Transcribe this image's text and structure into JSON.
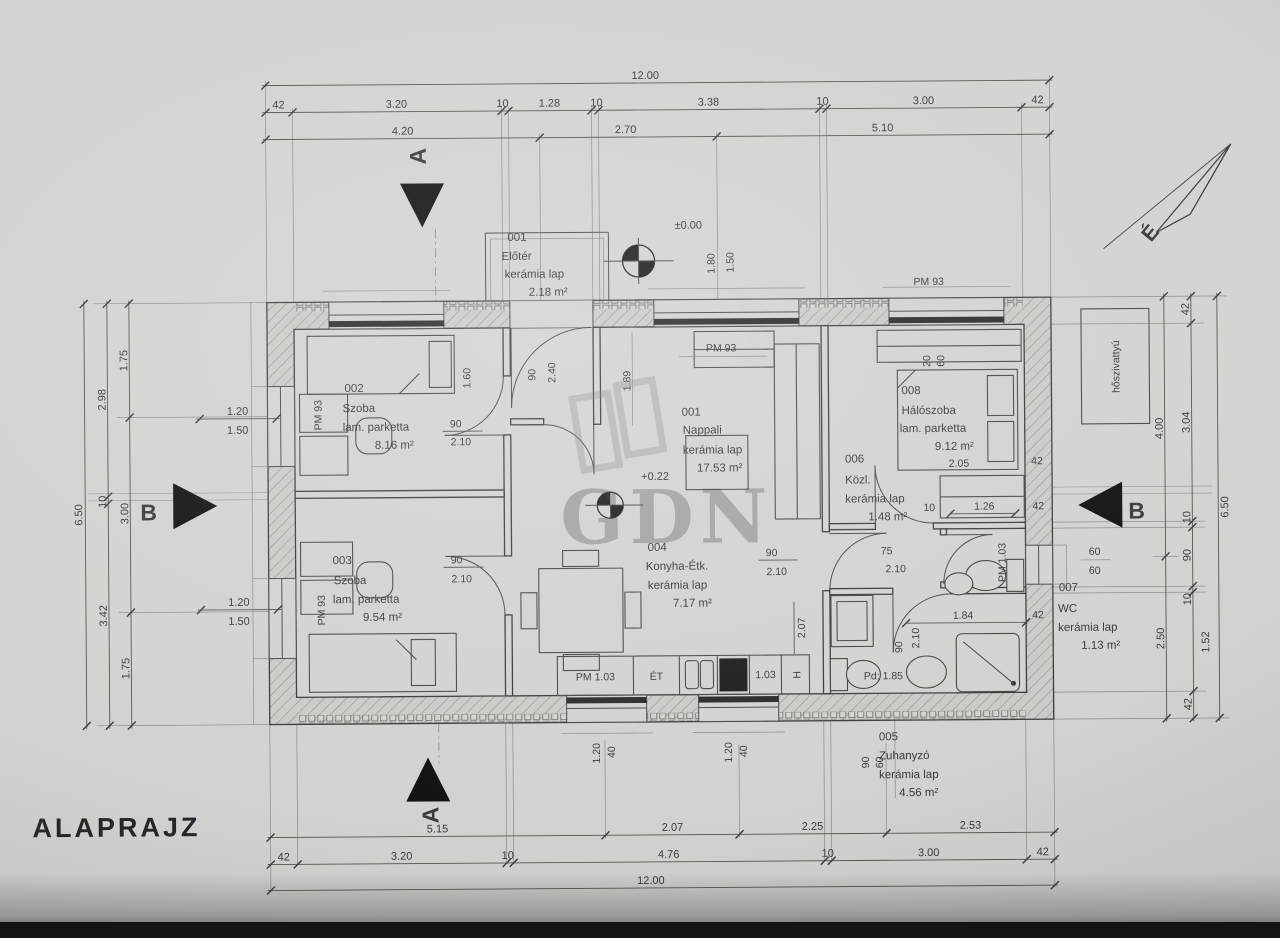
{
  "title": "ALAPRAJZ",
  "watermark": "GDN",
  "north_label": "É",
  "levels": {
    "zero": "±0.00",
    "floor": "+0.22"
  },
  "heat_pump_label": "hőszivattyú",
  "sections": {
    "a": "A",
    "b": "B"
  },
  "rooms": {
    "eloter": {
      "num": "001",
      "name": "Előtér",
      "floor": "kerámia lap",
      "area": "2.18 m²"
    },
    "szoba2": {
      "num": "002",
      "name": "Szoba",
      "floor": "lam. parketta",
      "area": "8.16 m²"
    },
    "szoba3": {
      "num": "003",
      "name": "Szoba",
      "floor": "lam. parketta",
      "area": "9.54 m²"
    },
    "nappali": {
      "num": "001",
      "name": "Nappali",
      "floor": "kerámia lap",
      "area": "17.53 m²"
    },
    "konyha": {
      "num": "004",
      "name": "Konyha-Étk.",
      "floor": "kerámia lap",
      "area": "7.17 m²"
    },
    "zuhanyzo": {
      "num": "005",
      "name": "Zuhanyzó",
      "floor": "kerámia lap",
      "area": "4.56 m²"
    },
    "kozl": {
      "num": "006",
      "name": "Közl.",
      "floor": "kerámia lap",
      "area": "1.48 m²"
    },
    "wc": {
      "num": "007",
      "name": "WC",
      "floor": "kerámia lap",
      "area": "1.13 m²"
    },
    "halo": {
      "num": "008",
      "name": "Hálószoba",
      "floor": "lam. parketta",
      "area": "9.12 m²"
    }
  },
  "pm_labels": {
    "top": "PM 93",
    "living": "PM 93",
    "szoba2": "PM 93",
    "szoba3": "PM 93",
    "bath": "PM 1.03"
  },
  "counter": {
    "pm": "PM 1.03",
    "et": "ÉT",
    "pm2": "1.03",
    "h": "H"
  },
  "pd_label": "Pd: 1.85",
  "dims": {
    "top": {
      "total": "12.00",
      "chain": [
        "42",
        "3.20",
        "10",
        "1.28",
        "10",
        "3.38",
        "10",
        "3.00",
        "42"
      ],
      "axes": [
        "4.20",
        "2.70",
        "5.10"
      ]
    },
    "bottom": {
      "total": "12.00",
      "chain": [
        "42",
        "3.20",
        "10",
        "4.76",
        "10",
        "3.00",
        "42"
      ],
      "axes": [
        "5.15",
        "2.07",
        "2.25",
        "2.53"
      ]
    },
    "left": {
      "total": "6.50",
      "chain": [
        "2.98",
        "10",
        "3.42"
      ],
      "axes": [
        "1.75",
        "3.00",
        "1.75"
      ],
      "win1": [
        "1.20",
        "1.50"
      ],
      "win2": [
        "1.20",
        "1.50"
      ]
    },
    "right": {
      "total": "6.50",
      "chain": [
        "42",
        "3.04",
        "10",
        "90",
        "10",
        "1.52",
        "42"
      ],
      "axes": [
        "4.00",
        "2.50"
      ],
      "win": [
        "60",
        "60"
      ]
    },
    "inner": {
      "door_szoba2": [
        "90",
        "2.10"
      ],
      "szoba2_h": "1.60",
      "door_szoba3": [
        "90",
        "2.10"
      ],
      "door_kozl": [
        "90",
        "2.10"
      ],
      "door_wc": [
        "75",
        "2.10"
      ],
      "door_zuh": [
        "90",
        "2.10"
      ],
      "entry": [
        "90",
        "2.40",
        "1.89"
      ],
      "entry_side": [
        "1.80",
        "1.50"
      ],
      "halo_win": [
        "20",
        "60"
      ],
      "halo_wardrobe": "2.05",
      "halo_42": "42",
      "kozl": [
        "10",
        "1.26",
        "42"
      ],
      "bath": [
        "1.84",
        "42"
      ],
      "kitchen_h": "2.07",
      "kwin1": [
        "1.20",
        "40"
      ],
      "kwin2": [
        "1.20",
        "40"
      ],
      "zuh": [
        "90",
        "60"
      ]
    }
  }
}
